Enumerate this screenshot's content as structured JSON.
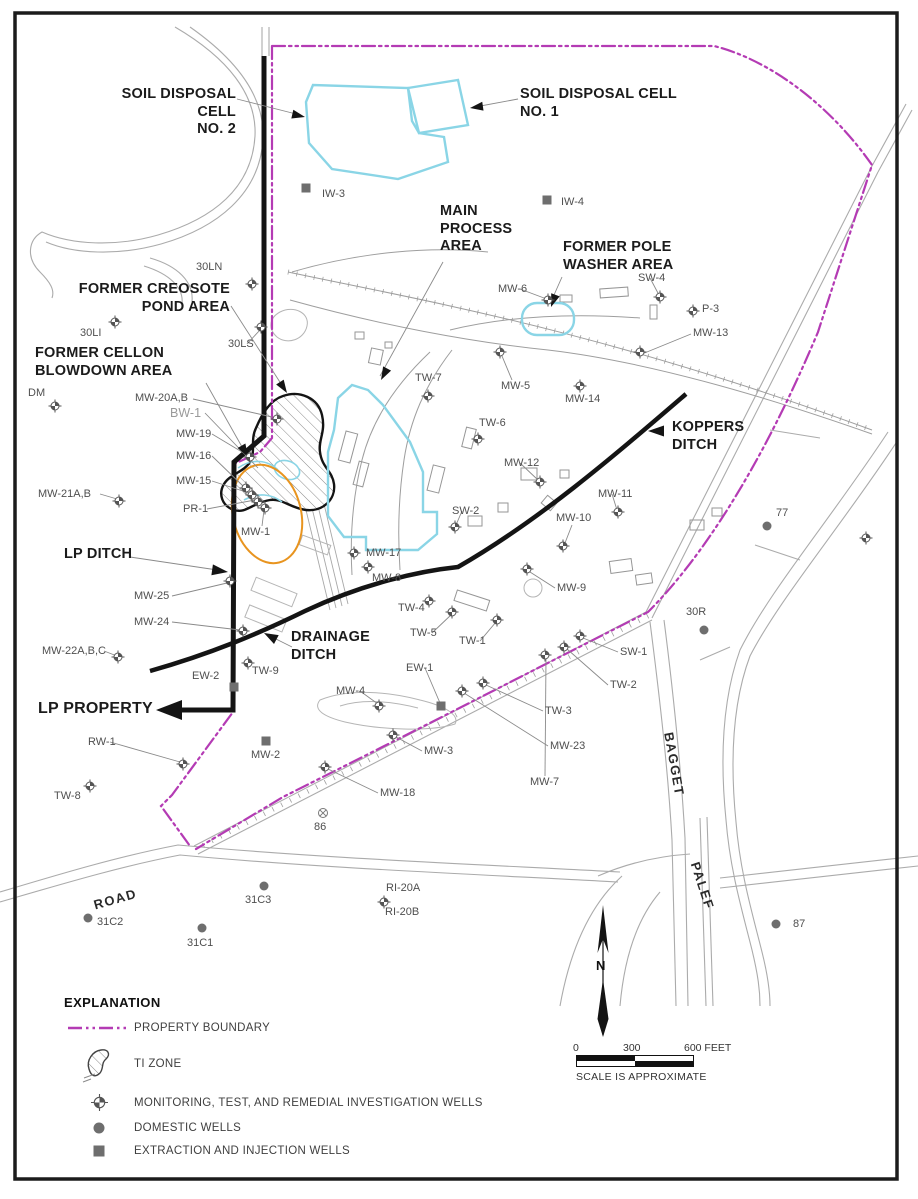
{
  "colors": {
    "property_boundary": "#b43bb4",
    "water_feature_cyan": "#8ad5e6",
    "ti_zone_outline": "#141414",
    "orange_zone": "#e8941f",
    "well_gray": "#6e6e6e",
    "map_line_gray": "#ababab"
  },
  "map": {
    "north_label": "N",
    "area_labels": [
      {
        "name": "soil-disposal-cell-2-label",
        "lines": [
          "SOIL DISPOSAL CELL",
          "NO. 2"
        ],
        "x": 90,
        "y": 86,
        "w": 146,
        "align": "right"
      },
      {
        "name": "soil-disposal-cell-1-label",
        "lines": [
          "SOIL DISPOSAL CELL",
          "NO. 1"
        ],
        "x": 520,
        "y": 86
      },
      {
        "name": "main-process-area-label",
        "lines": [
          "MAIN",
          "PROCESS",
          "AREA"
        ],
        "x": 440,
        "y": 203
      },
      {
        "name": "former-pole-washer-area-label",
        "lines": [
          "FORMER POLE",
          "WASHER AREA"
        ],
        "x": 563,
        "y": 239
      },
      {
        "name": "former-creosote-pond-area-label",
        "lines": [
          "FORMER CREOSOTE",
          "POND AREA"
        ],
        "x": 55,
        "y": 281,
        "w": 175,
        "align": "right"
      },
      {
        "name": "former-cellon-blowdown-area-label",
        "lines": [
          "FORMER CELLON",
          "BLOWDOWN AREA"
        ],
        "x": 35,
        "y": 345
      },
      {
        "name": "koppers-ditch-label",
        "lines": [
          "KOPPERS",
          "DITCH"
        ],
        "x": 672,
        "y": 419
      },
      {
        "name": "lp-ditch-label",
        "lines": [
          "LP DITCH"
        ],
        "x": 64,
        "y": 546
      },
      {
        "name": "drainage-ditch-label",
        "lines": [
          "DRAINAGE",
          "DITCH"
        ],
        "x": 291,
        "y": 629
      },
      {
        "name": "lp-property-label",
        "lines": [
          "LP PROPERTY"
        ],
        "x": 38,
        "y": 699,
        "size": 16
      }
    ],
    "road_labels": [
      {
        "name": "road-label-road",
        "text": "ROAD",
        "x": 92,
        "y": 898,
        "rot": -16
      },
      {
        "name": "road-label-bagget",
        "text": "BAGGET",
        "x": 676,
        "y": 731,
        "rot": 80
      },
      {
        "name": "road-label-palef",
        "text": "PALEF",
        "x": 702,
        "y": 860,
        "rot": 72
      }
    ],
    "wells": [
      {
        "type": "monitoring",
        "id": "30LN",
        "lx": 196,
        "ly": 262,
        "sx": 252,
        "sy": 284
      },
      {
        "type": "monitoring",
        "id": "30LI",
        "lx": 80,
        "ly": 328,
        "sx": 115,
        "sy": 322
      },
      {
        "type": "monitoring",
        "id": "30LS",
        "lx": 228,
        "ly": 339,
        "sx": 261,
        "sy": 327
      },
      {
        "type": "monitoring",
        "id": "DM",
        "lx": 28,
        "ly": 388,
        "sx": 55,
        "sy": 406
      },
      {
        "type": "monitoring",
        "id": "MW-20A,B",
        "lx": 135,
        "ly": 393,
        "sx": 277,
        "sy": 419
      },
      {
        "type": "monitoring",
        "id": "BW-1",
        "lx": 170,
        "ly": 407,
        "muted": true
      },
      {
        "type": "monitoring",
        "id": "MW-19",
        "lx": 176,
        "ly": 429,
        "sx": 250,
        "sy": 457
      },
      {
        "type": "monitoring",
        "id": "MW-16",
        "lx": 176,
        "ly": 451,
        "sx": 246,
        "sy": 488
      },
      {
        "type": "monitoring",
        "id": "MW-15",
        "lx": 176,
        "ly": 476,
        "sx": 252,
        "sy": 495
      },
      {
        "type": "monitoring",
        "id": "MW-21A,B",
        "lx": 38,
        "ly": 489,
        "sx": 119,
        "sy": 501
      },
      {
        "type": "monitoring",
        "id": "PR-1",
        "lx": 183,
        "ly": 504,
        "sx": 258,
        "sy": 502
      },
      {
        "type": "monitoring",
        "id": "MW-1",
        "lx": 241,
        "ly": 527,
        "sx": 265,
        "sy": 508
      },
      {
        "type": "monitoring",
        "id": "MW-17",
        "lx": 366,
        "ly": 548,
        "sx": 354,
        "sy": 553
      },
      {
        "type": "monitoring",
        "id": "MW-8",
        "lx": 372,
        "ly": 573,
        "sx": 368,
        "sy": 567
      },
      {
        "type": "monitoring",
        "id": "TW-4",
        "lx": 398,
        "ly": 603,
        "sx": 429,
        "sy": 601
      },
      {
        "type": "monitoring",
        "id": "TW-5",
        "lx": 410,
        "ly": 628,
        "sx": 452,
        "sy": 612
      },
      {
        "type": "monitoring",
        "id": "TW-1",
        "lx": 459,
        "ly": 636,
        "sx": 497,
        "sy": 620
      },
      {
        "type": "monitoring",
        "id": "MW-4",
        "lx": 336,
        "ly": 686,
        "sx": 379,
        "sy": 706
      },
      {
        "type": "monitoring",
        "id": "TW-3",
        "lx": 545,
        "ly": 706,
        "sx": 483,
        "sy": 683
      },
      {
        "type": "monitoring",
        "id": "MW-23",
        "lx": 550,
        "ly": 741,
        "sx": 462,
        "sy": 691
      },
      {
        "type": "monitoring",
        "id": "MW-3",
        "lx": 424,
        "ly": 746,
        "sx": 393,
        "sy": 735
      },
      {
        "type": "monitoring",
        "id": "MW-7",
        "lx": 530,
        "ly": 777,
        "sx": 545,
        "sy": 655
      },
      {
        "type": "monitoring",
        "id": "MW-18",
        "lx": 380,
        "ly": 788,
        "sx": 325,
        "sy": 767
      },
      {
        "type": "monitoring",
        "id": "TW-9",
        "lx": 252,
        "ly": 666,
        "sx": 248,
        "sy": 663
      },
      {
        "type": "monitoring",
        "id": "MW-25",
        "lx": 134,
        "ly": 591,
        "sx": 230,
        "sy": 581
      },
      {
        "type": "monitoring",
        "id": "MW-24",
        "lx": 134,
        "ly": 617,
        "sx": 243,
        "sy": 631
      },
      {
        "type": "monitoring",
        "id": "MW-22A,B,C",
        "lx": 42,
        "ly": 646,
        "sx": 118,
        "sy": 657
      },
      {
        "type": "monitoring",
        "id": "RW-1",
        "lx": 88,
        "ly": 737,
        "sx": 183,
        "sy": 764
      },
      {
        "type": "monitoring",
        "id": "TW-8",
        "lx": 54,
        "ly": 791,
        "sx": 90,
        "sy": 786
      },
      {
        "type": "monitoring",
        "id": "MW-6",
        "lx": 498,
        "ly": 284,
        "sx": 548,
        "sy": 300
      },
      {
        "type": "monitoring",
        "id": "TW-7",
        "lx": 415,
        "ly": 373,
        "sx": 428,
        "sy": 396
      },
      {
        "type": "monitoring",
        "id": "MW-5",
        "lx": 501,
        "ly": 381,
        "sx": 500,
        "sy": 352
      },
      {
        "type": "monitoring",
        "id": "MW-14",
        "lx": 565,
        "ly": 394,
        "sx": 580,
        "sy": 386
      },
      {
        "type": "monitoring",
        "id": "TW-6",
        "lx": 479,
        "ly": 418,
        "sx": 478,
        "sy": 439
      },
      {
        "type": "monitoring",
        "id": "MW-12",
        "lx": 504,
        "ly": 458,
        "sx": 540,
        "sy": 482
      },
      {
        "type": "monitoring",
        "id": "MW-13",
        "lx": 693,
        "ly": 328,
        "sx": 640,
        "sy": 352
      },
      {
        "type": "monitoring",
        "id": "P-3",
        "lx": 702,
        "ly": 304,
        "sx": 693,
        "sy": 311
      },
      {
        "type": "monitoring",
        "id": "SW-4",
        "lx": 638,
        "ly": 273,
        "sx": 660,
        "sy": 297
      },
      {
        "type": "monitoring",
        "id": "MW-11",
        "lx": 598,
        "ly": 489,
        "sx": 618,
        "sy": 512
      },
      {
        "type": "monitoring",
        "id": "MW-10",
        "lx": 556,
        "ly": 513,
        "sx": 563,
        "sy": 546
      },
      {
        "type": "monitoring",
        "id": "SW-2",
        "lx": 452,
        "ly": 506,
        "sx": 455,
        "sy": 527
      },
      {
        "type": "monitoring",
        "id": "MW-9",
        "lx": 557,
        "ly": 583,
        "sx": 527,
        "sy": 569
      },
      {
        "type": "monitoring",
        "id": "SW-1",
        "lx": 620,
        "ly": 647,
        "sx": 580,
        "sy": 636
      },
      {
        "type": "monitoring",
        "id": "TW-2",
        "lx": 610,
        "ly": 680,
        "sx": 564,
        "sy": 647
      },
      {
        "type": "monitoring",
        "id": "RI-20A",
        "lx": 386,
        "ly": 883,
        "sx": 384,
        "sy": 902
      },
      {
        "type": "monitoring",
        "id": "RI-20B",
        "lx": 385,
        "ly": 907
      },
      {
        "type": "monitoring",
        "id": "",
        "sx": 866,
        "sy": 538
      },
      {
        "type": "domestic",
        "id": "30R",
        "lx": 686,
        "ly": 607,
        "sx": 704,
        "sy": 630
      },
      {
        "type": "domestic",
        "id": "77",
        "lx": 776,
        "ly": 508,
        "sx": 767,
        "sy": 526
      },
      {
        "type": "domestic",
        "id": "87",
        "lx": 793,
        "ly": 919,
        "sx": 776,
        "sy": 924
      },
      {
        "type": "domestic",
        "id": "31C2",
        "lx": 97,
        "ly": 917,
        "sx": 88,
        "sy": 918
      },
      {
        "type": "domestic",
        "id": "31C1",
        "lx": 187,
        "ly": 938,
        "sx": 202,
        "sy": 928
      },
      {
        "type": "domestic",
        "id": "31C3",
        "lx": 245,
        "ly": 895,
        "sx": 264,
        "sy": 886
      },
      {
        "type": "extraction",
        "id": "IW-3",
        "lx": 322,
        "ly": 189,
        "sx": 306,
        "sy": 188
      },
      {
        "type": "extraction",
        "id": "IW-4",
        "lx": 561,
        "ly": 197,
        "sx": 547,
        "sy": 200
      },
      {
        "type": "extraction",
        "id": "MW-2",
        "lx": 251,
        "ly": 750,
        "sx": 266,
        "sy": 741
      },
      {
        "type": "extraction",
        "id": "EW-1",
        "lx": 406,
        "ly": 663,
        "sx": 441,
        "sy": 706
      },
      {
        "type": "extraction",
        "id": "EW-2",
        "lx": 192,
        "ly": 671,
        "sx": 234,
        "sy": 687
      },
      {
        "type": "circle-x",
        "id": "86",
        "lx": 314,
        "ly": 822,
        "sx": 323,
        "sy": 813
      }
    ]
  },
  "legend": {
    "title": "EXPLANATION",
    "items": [
      {
        "symbol": "property-boundary",
        "label": "PROPERTY BOUNDARY"
      },
      {
        "symbol": "ti-zone",
        "label": "TI ZONE"
      },
      {
        "symbol": "monitoring-well",
        "label": "MONITORING, TEST, AND REMEDIAL INVESTIGATION WELLS"
      },
      {
        "symbol": "domestic-well",
        "label": "DOMESTIC WELLS"
      },
      {
        "symbol": "extraction-well",
        "label": "EXTRACTION AND INJECTION WELLS"
      }
    ]
  },
  "scale": {
    "ticks": [
      "0",
      "300",
      "600 FEET"
    ],
    "note": "SCALE IS APPROXIMATE"
  }
}
